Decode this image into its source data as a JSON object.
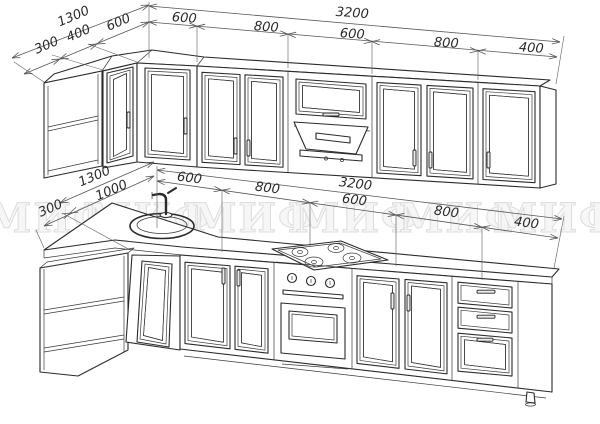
{
  "drawing": {
    "title": "kitchen-cabinet-set-technical-sketch"
  },
  "dimensions": {
    "upper_row": {
      "left_total": "1300",
      "left_segments": [
        "300",
        "400",
        "600"
      ],
      "main_total": "3200",
      "main_segments": [
        "600",
        "800",
        "600",
        "800",
        "400"
      ]
    },
    "lower_row": {
      "left_total": "1300",
      "left_segments": [
        "300",
        "1000"
      ],
      "main_total": "3200",
      "main_segments": [
        "600",
        "800",
        "600",
        "800",
        "400"
      ]
    }
  },
  "watermark": {
    "text": "МИФ",
    "repeat": 6
  },
  "colors": {
    "line": "#2b2b2b",
    "dim_line": "#555",
    "watermark": "#e8e8e8",
    "background": "#ffffff"
  }
}
